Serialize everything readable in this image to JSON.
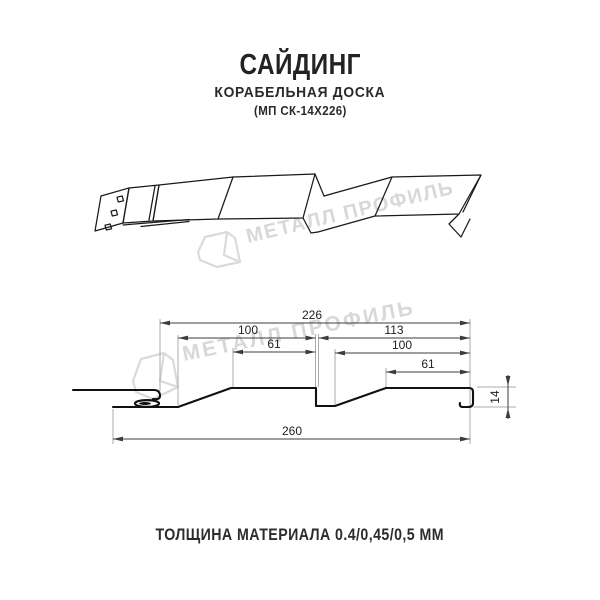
{
  "header": {
    "title": "САЙДИНГ",
    "subtitle": "КОРАБЕЛЬНАЯ ДОСКА",
    "model": "(МП СК-14Х226)"
  },
  "watermark": {
    "text": "МЕТАЛЛ ПРОФИЛЬ",
    "color": "#d8d8d8"
  },
  "section": {
    "dims": {
      "overall_top": "226",
      "left_module": "100",
      "left_flat": "61",
      "right_module": "113",
      "right_inner": "100",
      "right_flat": "61",
      "total_bottom": "260",
      "height": "14"
    }
  },
  "footer": {
    "thickness_note": "ТОЛЩИНА МАТЕРИАЛА 0.4/0,45/0,5 ММ"
  }
}
